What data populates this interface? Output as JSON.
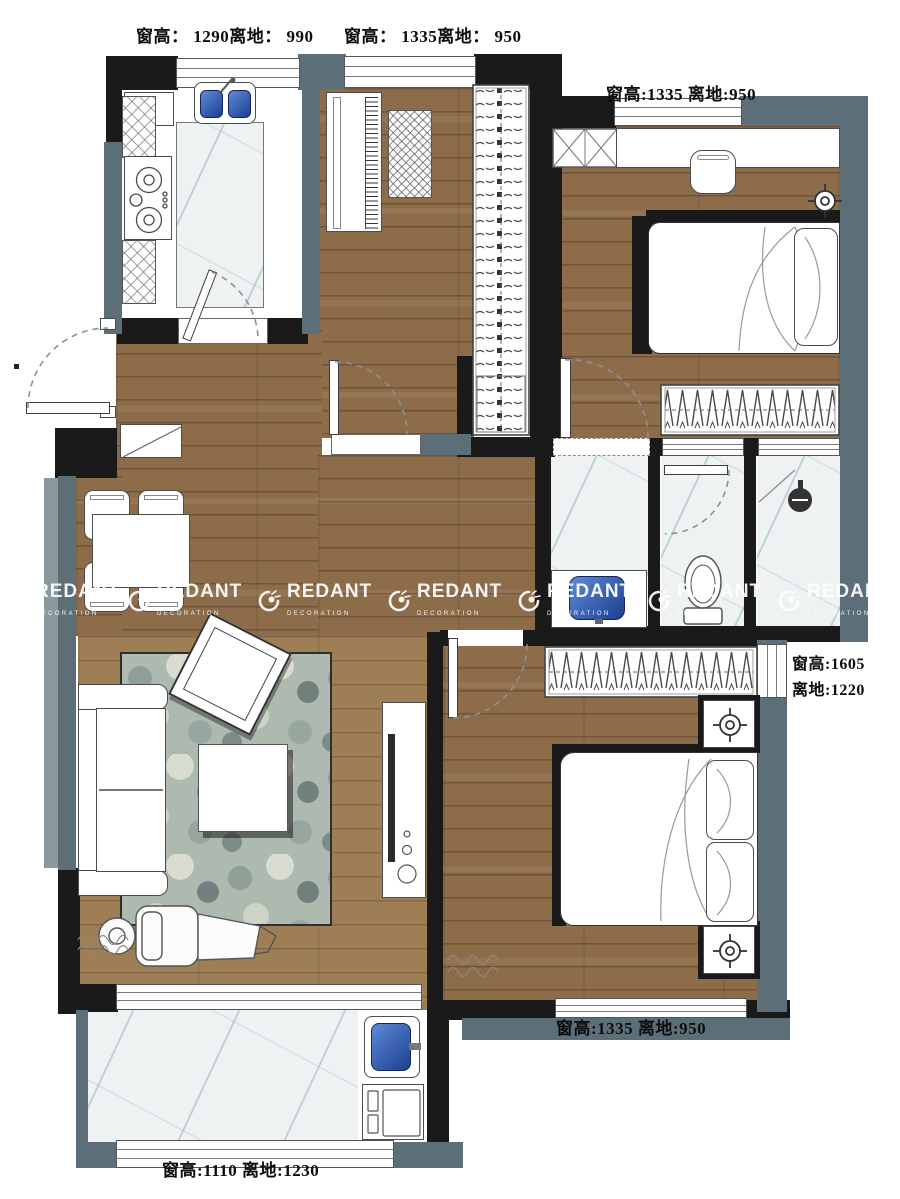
{
  "window_annotations": {
    "kitchen_top": "窗高： 1290离地： 990",
    "study_top": "窗高： 1335离地： 950",
    "bedroom2_top": "窗高:1335 离地:950",
    "master_right_l1": "窗高:1605",
    "master_right_l2": "离地:1220",
    "master_bottom": "窗高:1335 离地:950",
    "balcony_bottom": "窗高:1110 离地:1230"
  },
  "watermark": {
    "brand": "REDANT",
    "subtitle": "DECORATION",
    "icon": "redant-ant-logo",
    "count": 7
  },
  "colors": {
    "wall_dark": "#1a1a1a",
    "wall_slate": "#5c6f78",
    "wood_floor": "#8d6c4a",
    "wood_floor_light": "#9d7e55",
    "marble_floor": "#eef2f3",
    "sink_blue": "#2c5fc0",
    "rug_base": "#aeb9b0",
    "watermark_text": "#ffffff"
  }
}
